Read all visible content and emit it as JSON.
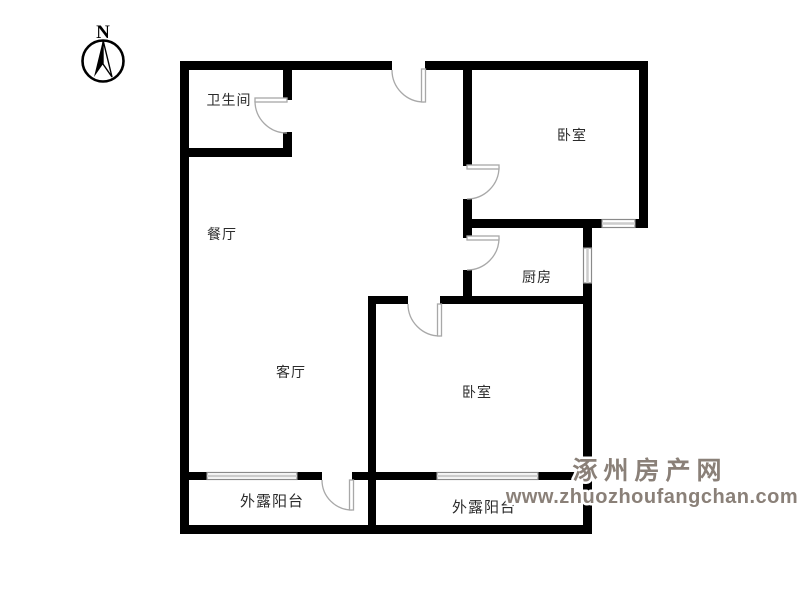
{
  "compass": {
    "label": "N"
  },
  "rooms": [
    {
      "id": "bathroom",
      "label": "卫生间"
    },
    {
      "id": "dining-room",
      "label": "餐厅"
    },
    {
      "id": "bedroom-1",
      "label": "卧室"
    },
    {
      "id": "kitchen",
      "label": "厨房"
    },
    {
      "id": "living-room",
      "label": "客厅"
    },
    {
      "id": "bedroom-2",
      "label": "卧室"
    },
    {
      "id": "balcony-left",
      "label": "外露阳台"
    },
    {
      "id": "balcony-right",
      "label": "外露阳台"
    }
  ],
  "watermark": {
    "site_name": "涿州房产网",
    "site_url": "www.zhuozhoufangchan.com",
    "color": "#8a8078"
  },
  "colors": {
    "wall": "#000000",
    "door": "#a8a8a8",
    "window_border": "#8a8a8a",
    "window_stripe": "#cccccc",
    "label": "#2b2b2b",
    "watermark": "#8a8078"
  }
}
